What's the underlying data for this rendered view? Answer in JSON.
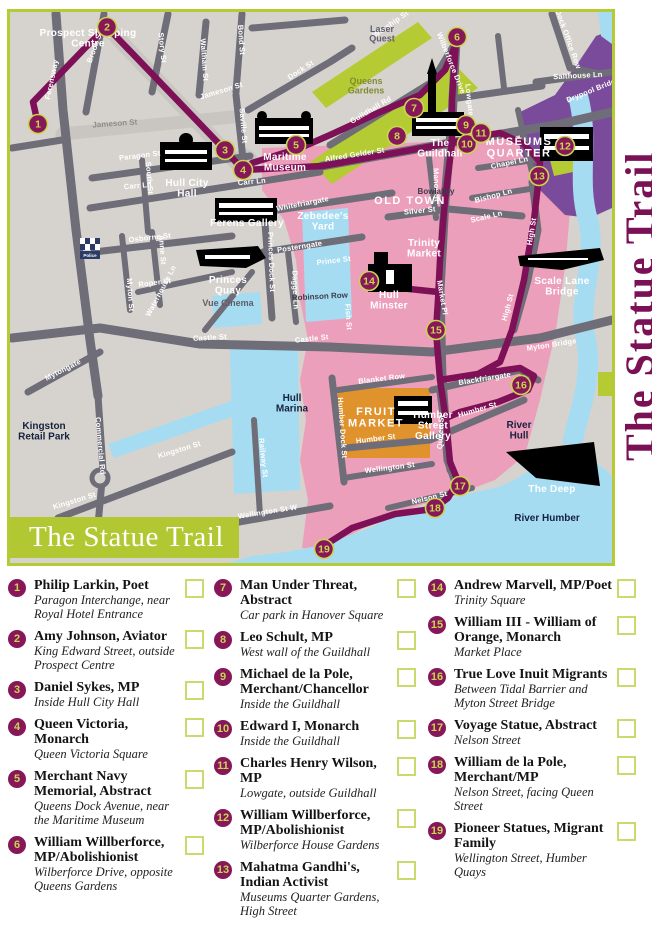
{
  "banner_title": "The Statue Trail",
  "side_title": "The Statue Trail",
  "colors": {
    "accent_lime": "#b2c832",
    "route_purple": "#7d1056",
    "old_town_pink": "#ec9fbb",
    "water_blue": "#a6dcf2",
    "fruit_market_orange": "#e0922c",
    "museums_purple": "#7b4b9b",
    "road_gray": "#6e6d78",
    "land_gray": "#d6d3ce",
    "title_magenta": "#7b1155",
    "marker_fill": "#871759",
    "marker_number": "#c9d64f"
  },
  "map": {
    "markers": [
      {
        "n": "1",
        "x": 38,
        "y": 124
      },
      {
        "n": "2",
        "x": 107,
        "y": 27
      },
      {
        "n": "3",
        "x": 225,
        "y": 150
      },
      {
        "n": "4",
        "x": 243,
        "y": 170
      },
      {
        "n": "5",
        "x": 296,
        "y": 145
      },
      {
        "n": "6",
        "x": 457,
        "y": 37
      },
      {
        "n": "7",
        "x": 414,
        "y": 108
      },
      {
        "n": "8",
        "x": 397,
        "y": 136
      },
      {
        "n": "9",
        "x": 466,
        "y": 125
      },
      {
        "n": "10",
        "x": 467,
        "y": 144
      },
      {
        "n": "11",
        "x": 481,
        "y": 133
      },
      {
        "n": "12",
        "x": 565,
        "y": 146
      },
      {
        "n": "13",
        "x": 539,
        "y": 176
      },
      {
        "n": "14",
        "x": 369,
        "y": 281
      },
      {
        "n": "15",
        "x": 436,
        "y": 330
      },
      {
        "n": "16",
        "x": 521,
        "y": 385
      },
      {
        "n": "17",
        "x": 460,
        "y": 486
      },
      {
        "n": "18",
        "x": 435,
        "y": 508
      },
      {
        "n": "19",
        "x": 324,
        "y": 549
      }
    ],
    "labels": [
      {
        "t": "Ferensway",
        "x": 54,
        "y": 80,
        "r": -78
      },
      {
        "t": "Brook St",
        "x": 97,
        "y": 48,
        "r": -70
      },
      {
        "t": "Story St",
        "x": 160,
        "y": 48,
        "r": 84
      },
      {
        "t": "Waltham St",
        "x": 202,
        "y": 60,
        "r": 86
      },
      {
        "t": "Bond St",
        "x": 239,
        "y": 40,
        "r": 86
      },
      {
        "t": "Dock St",
        "x": 302,
        "y": 72,
        "r": -33
      },
      {
        "t": "Saville St",
        "x": 241,
        "y": 126,
        "r": 85
      },
      {
        "t": "Jameson St",
        "x": 222,
        "y": 93,
        "r": -17
      },
      {
        "t": "Jameson St",
        "x": 115,
        "y": 126,
        "r": -4,
        "c": "std"
      },
      {
        "t": "Paragon St",
        "x": 140,
        "y": 158,
        "r": -7
      },
      {
        "t": "Carr Ln",
        "x": 138,
        "y": 188,
        "r": -5
      },
      {
        "t": "Carr Ln",
        "x": 252,
        "y": 184,
        "r": -5
      },
      {
        "t": "South St",
        "x": 147,
        "y": 178,
        "r": 86
      },
      {
        "t": "Anne St",
        "x": 160,
        "y": 250,
        "r": 86
      },
      {
        "t": "Myton St",
        "x": 128,
        "y": 295,
        "r": 86
      },
      {
        "t": "Osborne St",
        "x": 150,
        "y": 240,
        "r": -6
      },
      {
        "t": "Roper St",
        "x": 155,
        "y": 285,
        "r": -7
      },
      {
        "t": "Waterhouse Ln",
        "x": 163,
        "y": 292,
        "r": -62
      },
      {
        "t": "Mytongate",
        "x": 64,
        "y": 372,
        "r": -27
      },
      {
        "t": "Castle St",
        "x": 210,
        "y": 340,
        "r": -3
      },
      {
        "t": "Castle St",
        "x": 312,
        "y": 341,
        "r": -6
      },
      {
        "t": "Myton Bridge",
        "x": 552,
        "y": 347,
        "r": -9
      },
      {
        "t": "Commercial Rd",
        "x": 98,
        "y": 446,
        "r": 85
      },
      {
        "t": "Kingston St",
        "x": 75,
        "y": 503,
        "r": -17
      },
      {
        "t": "Kingston St",
        "x": 180,
        "y": 452,
        "r": -17
      },
      {
        "t": "Railway St",
        "x": 261,
        "y": 458,
        "r": 84
      },
      {
        "t": "Wellington St W",
        "x": 268,
        "y": 514,
        "r": -9
      },
      {
        "t": "Humber Dock St",
        "x": 340,
        "y": 428,
        "r": 86
      },
      {
        "t": "Queen St",
        "x": 443,
        "y": 432,
        "r": -87
      },
      {
        "t": "Nelson St",
        "x": 430,
        "y": 500,
        "r": -14
      },
      {
        "t": "Wellington St",
        "x": 390,
        "y": 470,
        "r": -7
      },
      {
        "t": "Blanket Row",
        "x": 382,
        "y": 381,
        "r": -7
      },
      {
        "t": "Humber St",
        "x": 478,
        "y": 412,
        "r": -16
      },
      {
        "t": "Humber St",
        "x": 376,
        "y": 441,
        "r": -7
      },
      {
        "t": "Blackfriargate",
        "x": 485,
        "y": 381,
        "r": -9
      },
      {
        "t": "Whitefriargate",
        "x": 303,
        "y": 206,
        "r": -11
      },
      {
        "t": "Posterngate",
        "x": 300,
        "y": 249,
        "r": -9
      },
      {
        "t": "Prince St",
        "x": 334,
        "y": 263,
        "r": -7
      },
      {
        "t": "Princes Dock St",
        "x": 269,
        "y": 262,
        "r": 88
      },
      {
        "t": "Dagger Ln",
        "x": 293,
        "y": 290,
        "r": 88
      },
      {
        "t": "Silver St",
        "x": 420,
        "y": 213,
        "r": -6
      },
      {
        "t": "Scale Ln",
        "x": 487,
        "y": 219,
        "r": -13
      },
      {
        "t": "Bishop Ln",
        "x": 494,
        "y": 198,
        "r": -15
      },
      {
        "t": "Chapel Ln",
        "x": 510,
        "y": 165,
        "r": -12
      },
      {
        "t": "Manor St",
        "x": 434,
        "y": 185,
        "r": 88
      },
      {
        "t": "Bowlalley",
        "x": 436,
        "y": 194,
        "c": "dk"
      },
      {
        "t": "High St",
        "x": 534,
        "y": 232,
        "r": -80
      },
      {
        "t": "High St",
        "x": 510,
        "y": 308,
        "r": -75
      },
      {
        "t": "Lowgate",
        "x": 467,
        "y": 100,
        "r": 84
      },
      {
        "t": "Wilberforce Drive",
        "x": 449,
        "y": 64,
        "r": 68
      },
      {
        "t": "Worship St",
        "x": 392,
        "y": 26,
        "r": -35
      },
      {
        "t": "Alfred Gelder St",
        "x": 355,
        "y": 157,
        "r": -9
      },
      {
        "t": "Guildhall Rd",
        "x": 372,
        "y": 112,
        "r": -31
      },
      {
        "t": "Salthouse Ln",
        "x": 578,
        "y": 78,
        "r": -3
      },
      {
        "t": "Drypool Bridge",
        "x": 594,
        "y": 92,
        "r": -22
      },
      {
        "t": "Dock Office Row",
        "x": 566,
        "y": 40,
        "r": 70
      },
      {
        "t": "Market Pl",
        "x": 440,
        "y": 298,
        "r": 80
      },
      {
        "t": "Fish St",
        "x": 346,
        "y": 317,
        "r": 86,
        "s": 5.5
      },
      {
        "t": "Robinson Row",
        "x": 320,
        "y": 299,
        "r": -3,
        "c": "dk",
        "s": 4.5
      },
      {
        "t": [
          "Prospect Shopping",
          "Centre"
        ],
        "x": 88,
        "y": 36,
        "c": "area",
        "s": 9
      },
      {
        "t": [
          "Laser",
          "Quest"
        ],
        "x": 382,
        "y": 32,
        "c": "gray"
      },
      {
        "t": [
          "Queens",
          "Gardens"
        ],
        "x": 366,
        "y": 84,
        "c": "olive"
      },
      {
        "t": "OLD TOWN",
        "x": 410,
        "y": 204,
        "c": "areaXL"
      },
      {
        "t": [
          "MUSEUMS",
          "QUARTER"
        ],
        "x": 519,
        "y": 145,
        "c": "areaXL",
        "s": 10
      },
      {
        "t": [
          "Trinity",
          "Market"
        ],
        "x": 424,
        "y": 246,
        "c": "area"
      },
      {
        "t": [
          "Zebedee's",
          "Yard"
        ],
        "x": 323,
        "y": 219,
        "c": "area"
      },
      {
        "t": [
          "Hull",
          "Marina"
        ],
        "x": 292,
        "y": 401,
        "c": "navy"
      },
      {
        "t": [
          "Kingston",
          "Retail Park"
        ],
        "x": 44,
        "y": 429,
        "c": "navy",
        "s": 9
      },
      {
        "t": [
          "River",
          "Hull"
        ],
        "x": 519,
        "y": 428,
        "c": "navy"
      },
      {
        "t": "River Humber",
        "x": 547,
        "y": 521,
        "c": "navy"
      },
      {
        "t": [
          "Hull City",
          "Hall"
        ],
        "x": 187,
        "y": 186,
        "c": "area"
      },
      {
        "t": [
          "Maritime",
          "Museum"
        ],
        "x": 285,
        "y": 160,
        "c": "area"
      },
      {
        "t": "Ferens Gallery",
        "x": 247,
        "y": 226,
        "c": "area"
      },
      {
        "t": [
          "Princes",
          "Quay"
        ],
        "x": 228,
        "y": 283,
        "c": "area",
        "s": 9
      },
      {
        "t": "Vue Cinema",
        "x": 228,
        "y": 306,
        "c": "gray",
        "s": 9
      },
      {
        "t": [
          "The",
          "Guildhall"
        ],
        "x": 440,
        "y": 146,
        "c": "area",
        "s": 9
      },
      {
        "t": [
          "Hull",
          "Minster"
        ],
        "x": 389,
        "y": 298,
        "c": "area",
        "s": 9
      },
      {
        "t": [
          "Scale Lane",
          "Bridge"
        ],
        "x": 562,
        "y": 284,
        "c": "area",
        "s": 8
      },
      {
        "t": "The Deep",
        "x": 552,
        "y": 492,
        "c": "area",
        "s": 9
      },
      {
        "t": [
          "Humber",
          "Street",
          "Gallery"
        ],
        "x": 433,
        "y": 418,
        "c": "area",
        "s": 9,
        "a": "end"
      },
      {
        "t": [
          "FRUIT",
          "MARKET"
        ],
        "x": 376,
        "y": 415,
        "c": "areaXL",
        "s": 11
      },
      {
        "t": "Police",
        "x": 90,
        "y": 257,
        "c": "tiny"
      }
    ]
  },
  "legend": {
    "columns": [
      [
        {
          "num": "1",
          "title": "Philip Larkin, Poet",
          "location": "Paragon Interchange, near Royal Hotel Entrance"
        },
        {
          "num": "2",
          "title": "Amy Johnson, Aviator",
          "location": "King Edward Street, outside Prospect Centre"
        },
        {
          "num": "3",
          "title": "Daniel Sykes, MP",
          "location": "Inside Hull City Hall"
        },
        {
          "num": "4",
          "title": "Queen Victoria, Monarch",
          "location": "Queen Victoria Square"
        },
        {
          "num": "5",
          "title": "Merchant Navy Memorial, Abstract",
          "location": "Queens Dock Avenue, near the Maritime Museum"
        },
        {
          "num": "6",
          "title": "William Willberforce, MP/Abolishionist",
          "location": "Wilberforce Drive, opposite Queens Gardens"
        }
      ],
      [
        {
          "num": "7",
          "title": "Man Under Threat, Abstract",
          "location": "Car park in Hanover Square"
        },
        {
          "num": "8",
          "title": "Leo Schult, MP",
          "location": "West wall of the Guildhall"
        },
        {
          "num": "9",
          "title": "Michael de la Pole, Merchant/Chancellor",
          "location": "Inside the Guildhall"
        },
        {
          "num": "10",
          "title": "Edward I, Monarch",
          "location": "Inside the Guildhall"
        },
        {
          "num": "11",
          "title": "Charles Henry Wilson, MP",
          "location": "Lowgate, outside Guildhall"
        },
        {
          "num": "12",
          "title": "William Willberforce, MP/Abolishionist",
          "location": "Wilberforce House Gardens"
        },
        {
          "num": "13",
          "title": "Mahatma Gandhi's, Indian Activist",
          "location": "Museums Quarter Gardens, High Street"
        }
      ],
      [
        {
          "num": "14",
          "title": "Andrew Marvell, MP/Poet",
          "location": "Trinity Square"
        },
        {
          "num": "15",
          "title": "William III - William of Orange, Monarch",
          "location": "Market Place"
        },
        {
          "num": "16",
          "title": "True Love Inuit Migrants",
          "location": "Between Tidal Barrier and Myton Street Bridge"
        },
        {
          "num": "17",
          "title": "Voyage Statue, Abstract",
          "location": "Nelson Street"
        },
        {
          "num": "18",
          "title": "William de la Pole, Merchant/MP",
          "location": "Nelson Street, facing Queen Street"
        },
        {
          "num": "19",
          "title": "Pioneer Statues, Migrant Family",
          "location": "Wellington Street, Humber Quays"
        }
      ]
    ]
  }
}
